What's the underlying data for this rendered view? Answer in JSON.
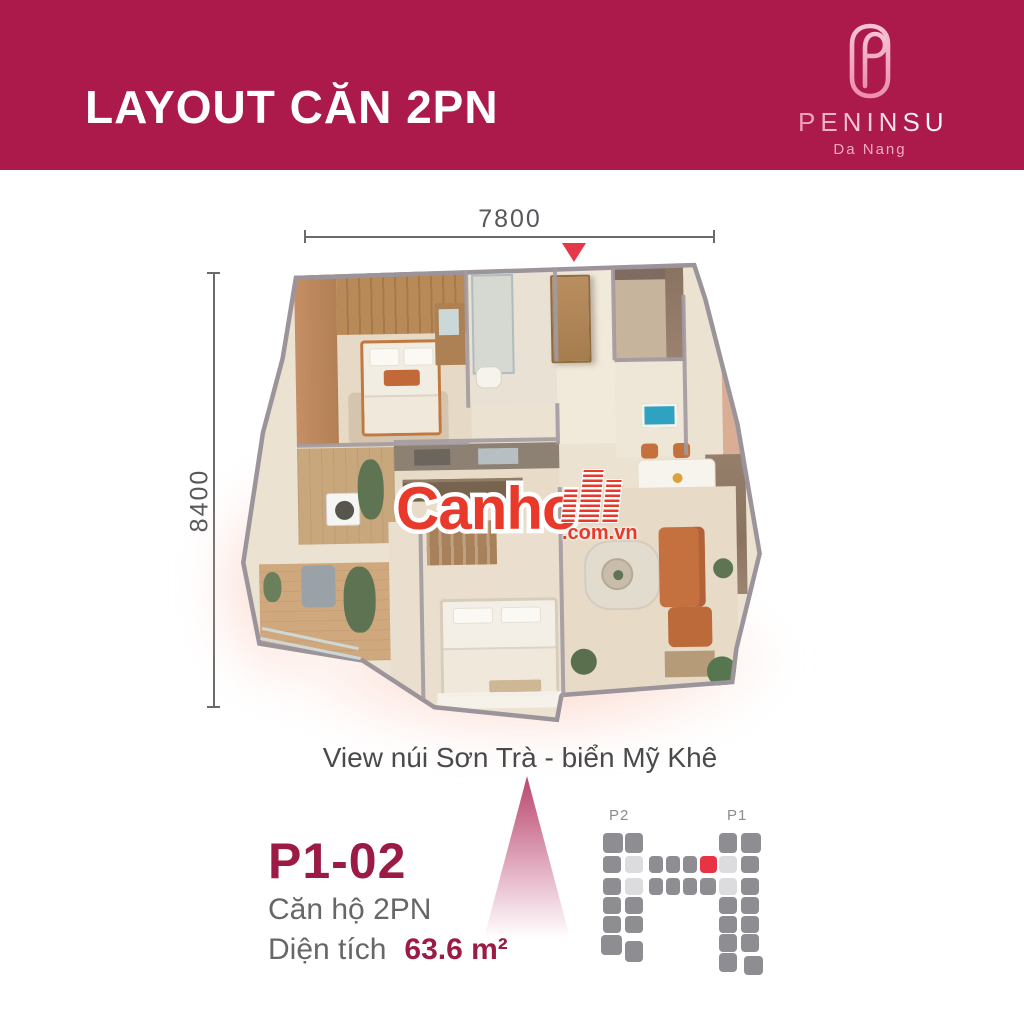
{
  "header": {
    "title": "LAYOUT CĂN 2PN",
    "background": "#ab1a4a",
    "logo": {
      "brand": "PENINSULA",
      "location": "Da Nang"
    }
  },
  "dimensions": {
    "width_label": "7800",
    "height_label": "8400"
  },
  "watermark": {
    "name": "Canho",
    "domain_suffix": ".com.vn",
    "color": "#e8392b"
  },
  "caption": {
    "view": "View núi Sơn Trà - biển Mỹ Khê"
  },
  "unit_info": {
    "code": "P1-02",
    "type": "Căn hộ 2PN",
    "area_label": "Diện tích",
    "area_value": "63.6 m²"
  },
  "site_plan": {
    "tower_left_label": "P2",
    "tower_right_label": "P1",
    "colors": {
      "d": "#8e8e92",
      "l": "#dcdcdf",
      "r": "#e73445"
    },
    "cells": [
      {
        "x": 8,
        "y": 28,
        "w": 20,
        "h": 20,
        "c": "d"
      },
      {
        "x": 8,
        "y": 51,
        "w": 18,
        "h": 17,
        "c": "d"
      },
      {
        "x": 8,
        "y": 73,
        "w": 18,
        "h": 17,
        "c": "d"
      },
      {
        "x": 8,
        "y": 92,
        "w": 18,
        "h": 17,
        "c": "d"
      },
      {
        "x": 8,
        "y": 111,
        "w": 18,
        "h": 17,
        "c": "d"
      },
      {
        "x": 6,
        "y": 130,
        "w": 21,
        "h": 20,
        "c": "d"
      },
      {
        "x": 30,
        "y": 28,
        "w": 18,
        "h": 20,
        "c": "d"
      },
      {
        "x": 30,
        "y": 51,
        "w": 18,
        "h": 17,
        "c": "l"
      },
      {
        "x": 30,
        "y": 73,
        "w": 18,
        "h": 17,
        "c": "l"
      },
      {
        "x": 30,
        "y": 92,
        "w": 18,
        "h": 17,
        "c": "d"
      },
      {
        "x": 30,
        "y": 111,
        "w": 18,
        "h": 17,
        "c": "d"
      },
      {
        "x": 30,
        "y": 136,
        "w": 18,
        "h": 21,
        "c": "d"
      },
      {
        "x": 54,
        "y": 51,
        "w": 14,
        "h": 17,
        "c": "d"
      },
      {
        "x": 71,
        "y": 51,
        "w": 14,
        "h": 17,
        "c": "d"
      },
      {
        "x": 88,
        "y": 51,
        "w": 14,
        "h": 17,
        "c": "d"
      },
      {
        "x": 105,
        "y": 51,
        "w": 17,
        "h": 17,
        "c": "r"
      },
      {
        "x": 124,
        "y": 51,
        "w": 18,
        "h": 17,
        "c": "l"
      },
      {
        "x": 54,
        "y": 73,
        "w": 14,
        "h": 17,
        "c": "d"
      },
      {
        "x": 71,
        "y": 73,
        "w": 14,
        "h": 17,
        "c": "d"
      },
      {
        "x": 88,
        "y": 73,
        "w": 14,
        "h": 17,
        "c": "d"
      },
      {
        "x": 105,
        "y": 73,
        "w": 16,
        "h": 17,
        "c": "d"
      },
      {
        "x": 124,
        "y": 73,
        "w": 18,
        "h": 17,
        "c": "l"
      },
      {
        "x": 124,
        "y": 28,
        "w": 18,
        "h": 20,
        "c": "d"
      },
      {
        "x": 124,
        "y": 92,
        "w": 18,
        "h": 17,
        "c": "d"
      },
      {
        "x": 124,
        "y": 111,
        "w": 18,
        "h": 17,
        "c": "d"
      },
      {
        "x": 124,
        "y": 129,
        "w": 18,
        "h": 18,
        "c": "d"
      },
      {
        "x": 124,
        "y": 148,
        "w": 18,
        "h": 19,
        "c": "d"
      },
      {
        "x": 146,
        "y": 28,
        "w": 20,
        "h": 20,
        "c": "d"
      },
      {
        "x": 146,
        "y": 51,
        "w": 18,
        "h": 17,
        "c": "d"
      },
      {
        "x": 146,
        "y": 73,
        "w": 18,
        "h": 17,
        "c": "d"
      },
      {
        "x": 146,
        "y": 92,
        "w": 18,
        "h": 17,
        "c": "d"
      },
      {
        "x": 146,
        "y": 111,
        "w": 18,
        "h": 17,
        "c": "d"
      },
      {
        "x": 146,
        "y": 129,
        "w": 18,
        "h": 18,
        "c": "d"
      },
      {
        "x": 149,
        "y": 151,
        "w": 19,
        "h": 19,
        "c": "d"
      }
    ]
  }
}
